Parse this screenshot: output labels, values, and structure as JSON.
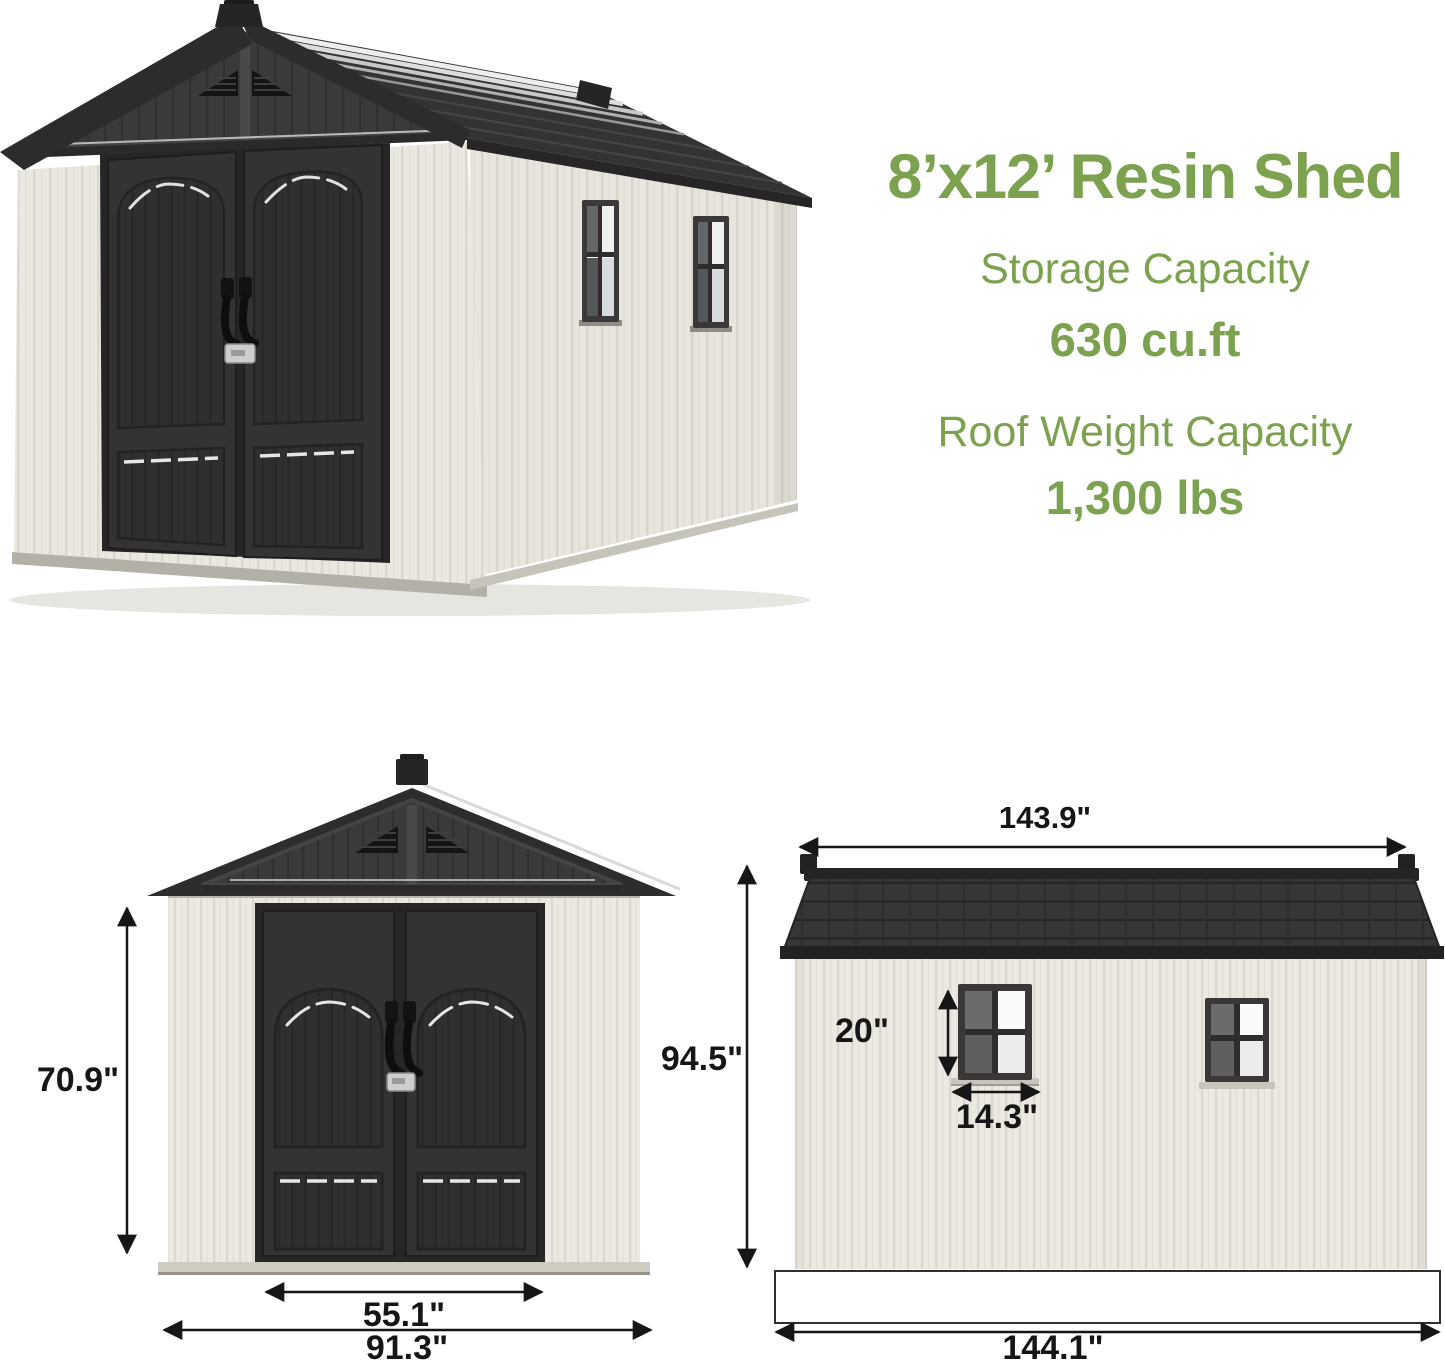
{
  "title": "8’x12’ Resin Shed",
  "specs": [
    {
      "label": "Storage Capacity",
      "value": "630 cu.ft"
    },
    {
      "label": "Roof Weight Capacity",
      "value": "1,300 lbs"
    }
  ],
  "front_view": {
    "wall_height": "70.9\"",
    "door_width": "55.1\"",
    "base_width": "91.3\""
  },
  "side_view": {
    "roof_length": "143.9\"",
    "overall_height": "94.5\"",
    "window_height": "20\"",
    "window_width": "14.3\"",
    "base_length": "144.1\""
  },
  "colors": {
    "accent_green": "#7CA14F",
    "shed_dark": "#2E2C2D",
    "wall_white": "#ECE9E2",
    "dimension_text": "#161616"
  }
}
